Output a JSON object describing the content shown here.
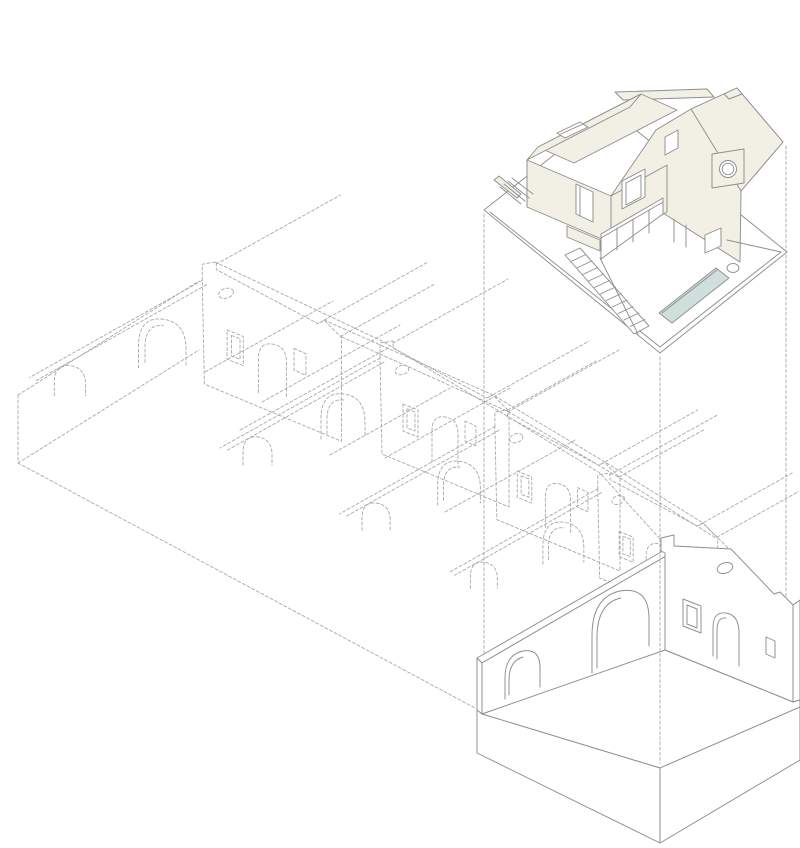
{
  "diagram": {
    "kind": "exploded axonometric architectural drawing",
    "parts": {
      "ghost_building": "existing multi-gable building (dashed wireframe)",
      "retained_shell": "retained single gabled bay shell on plinth",
      "projection_prism": "dashed projection lines linking shell to new house",
      "new_house": "new house volume with courtyard, stairs and pool"
    }
  },
  "colors": {
    "background": "#ffffff",
    "line": "#8e8e8e",
    "dash": "#a8a8a8",
    "wall": "#f2f0e4",
    "pool": "#cfe0dc",
    "white": "#ffffff"
  }
}
